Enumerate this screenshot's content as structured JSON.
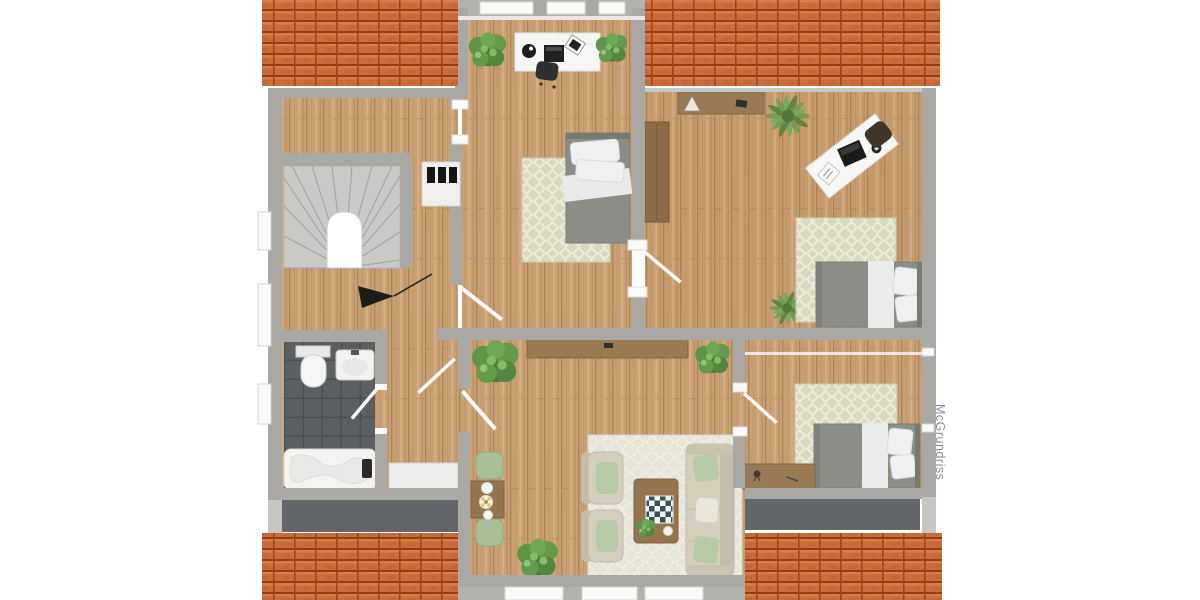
{
  "watermark": {
    "text": "McGrundriss",
    "color": "#8d8d8d"
  },
  "palette": {
    "background": "#ffffff",
    "roof_tile": "#ca6c3b",
    "roof_groove": "#8f3e15",
    "wall_gray": "#a9a8a4",
    "wood_floor": "#c8a074",
    "bathroom_tile": "#5b5f62",
    "terrace_gray": "#63676a",
    "stairs_gray": "#c9c9c8",
    "bed_gray": "#8b8e87",
    "linen_white": "#eef0f1",
    "rug_beige": "#d8dabf",
    "living_rug": "#e7e5da",
    "sofa_beige": "#d4cebc",
    "cushion_green": "#b7c9a6",
    "stool_green": "#a9bf97",
    "furniture_brown": "#9a7a54",
    "desk_white": "#f6f6f5",
    "plant_green": "#4d7a3a",
    "accent_black": "#1c1c1c"
  },
  "rooms": [
    {
      "id": "stair-hall",
      "furniture": [
        "winder-staircase",
        "chimney",
        "stair-direction-arrow"
      ]
    },
    {
      "id": "dormer-bedroom",
      "furniture": [
        "desk",
        "desk-chair",
        "laptop",
        "plant",
        "plant",
        "single-bed",
        "rug"
      ]
    },
    {
      "id": "office-guest-room",
      "furniture": [
        "sideboard",
        "wardrobe",
        "angled-desk",
        "desk-chair",
        "rug",
        "single-bed",
        "plant",
        "plant"
      ]
    },
    {
      "id": "bedroom-bottom-right",
      "furniture": [
        "rug",
        "single-bed",
        "desk"
      ]
    },
    {
      "id": "living-room",
      "furniture": [
        "sideboard",
        "armchair",
        "armchair",
        "sofa",
        "coffee-table",
        "checkerboard",
        "side-table",
        "stool",
        "stool",
        "plant",
        "plant",
        "plant"
      ]
    },
    {
      "id": "bathroom",
      "furniture": [
        "toilet",
        "washbasin",
        "bathtub"
      ]
    },
    {
      "id": "corridor",
      "furniture": [
        "built-in-closet"
      ]
    }
  ],
  "exterior": [
    "roof-top-left",
    "roof-top-right",
    "roof-bottom-left",
    "roof-bottom-right",
    "terrace-left",
    "terrace-right"
  ]
}
